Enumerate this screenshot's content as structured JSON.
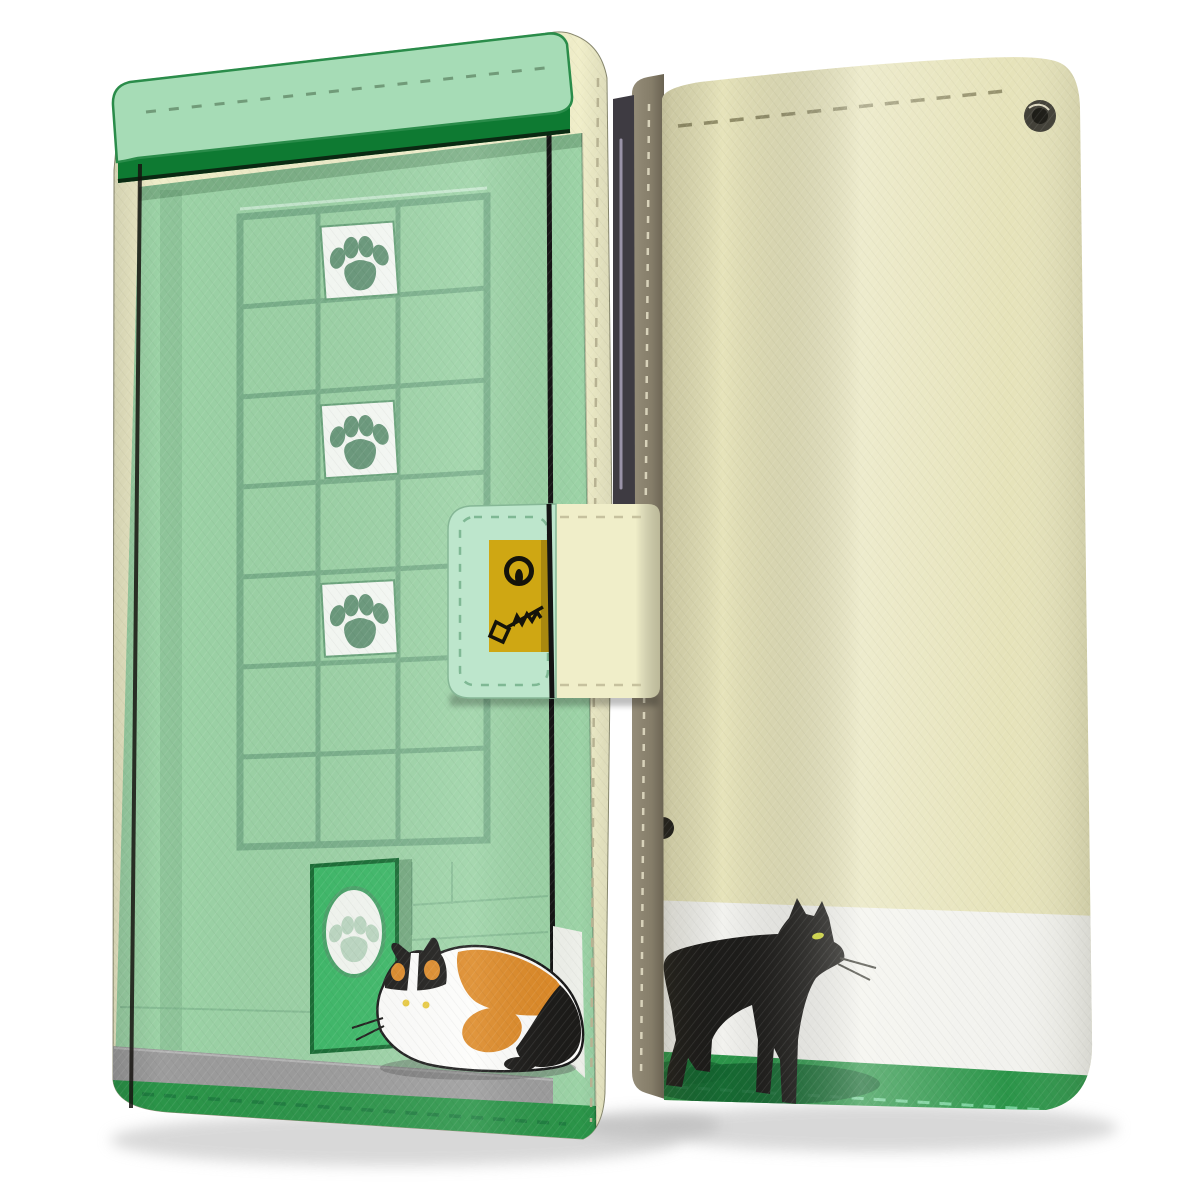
{
  "product": {
    "type": "smartphone wallet flip-case product photo, cat design",
    "views": {
      "left": "front cover, clasp closed",
      "right": "back cover with spine"
    },
    "motifs": {
      "front": "mint-green house wall with window grid, white paw-print tiles, green cat-flap door with paw oval, crouching calico cat on grey step, green grass band",
      "back": "cream wall, black cat walking on green grass band with white strip",
      "clasp": "gold lock emblem with keyhole ring and scribbled key",
      "hardware": "metal eyelet at top right, stitched edges all around"
    },
    "counts": {
      "paw_print_tiles": 3,
      "door_paw_ovals": 1,
      "cats": 2,
      "eyelets": 1
    }
  },
  "palette": {
    "mint_wall": "#9cd3a6",
    "mint_awning": "#a6dcb6",
    "green_trim": "#0e7a32",
    "green_band": "#2b9549",
    "grid_green": "#79b08a",
    "tile_white": "#f7fbf6",
    "paw_green": "#68987a",
    "oval_paw": "#bcd8c2",
    "flap_green": "#3db968",
    "step_gray": "#9c9c9c",
    "cream_edge": "#f0eec9",
    "clasp_mint": "#bde6cc",
    "gold": "#cfa713",
    "back_khaki": "#e6e3ba",
    "white_band": "#f2f2ee",
    "spine_olive": "#857d69",
    "phone_dark": "#3e3b42",
    "cat_black": "#1d1c1a",
    "cat_white": "#fdfdfb",
    "calico_orange": "#dd8a28",
    "eye_yellow": "#e8c93e",
    "cat_eye_green": "#d6de3a",
    "shadow_gray": "#d2d2d2"
  }
}
